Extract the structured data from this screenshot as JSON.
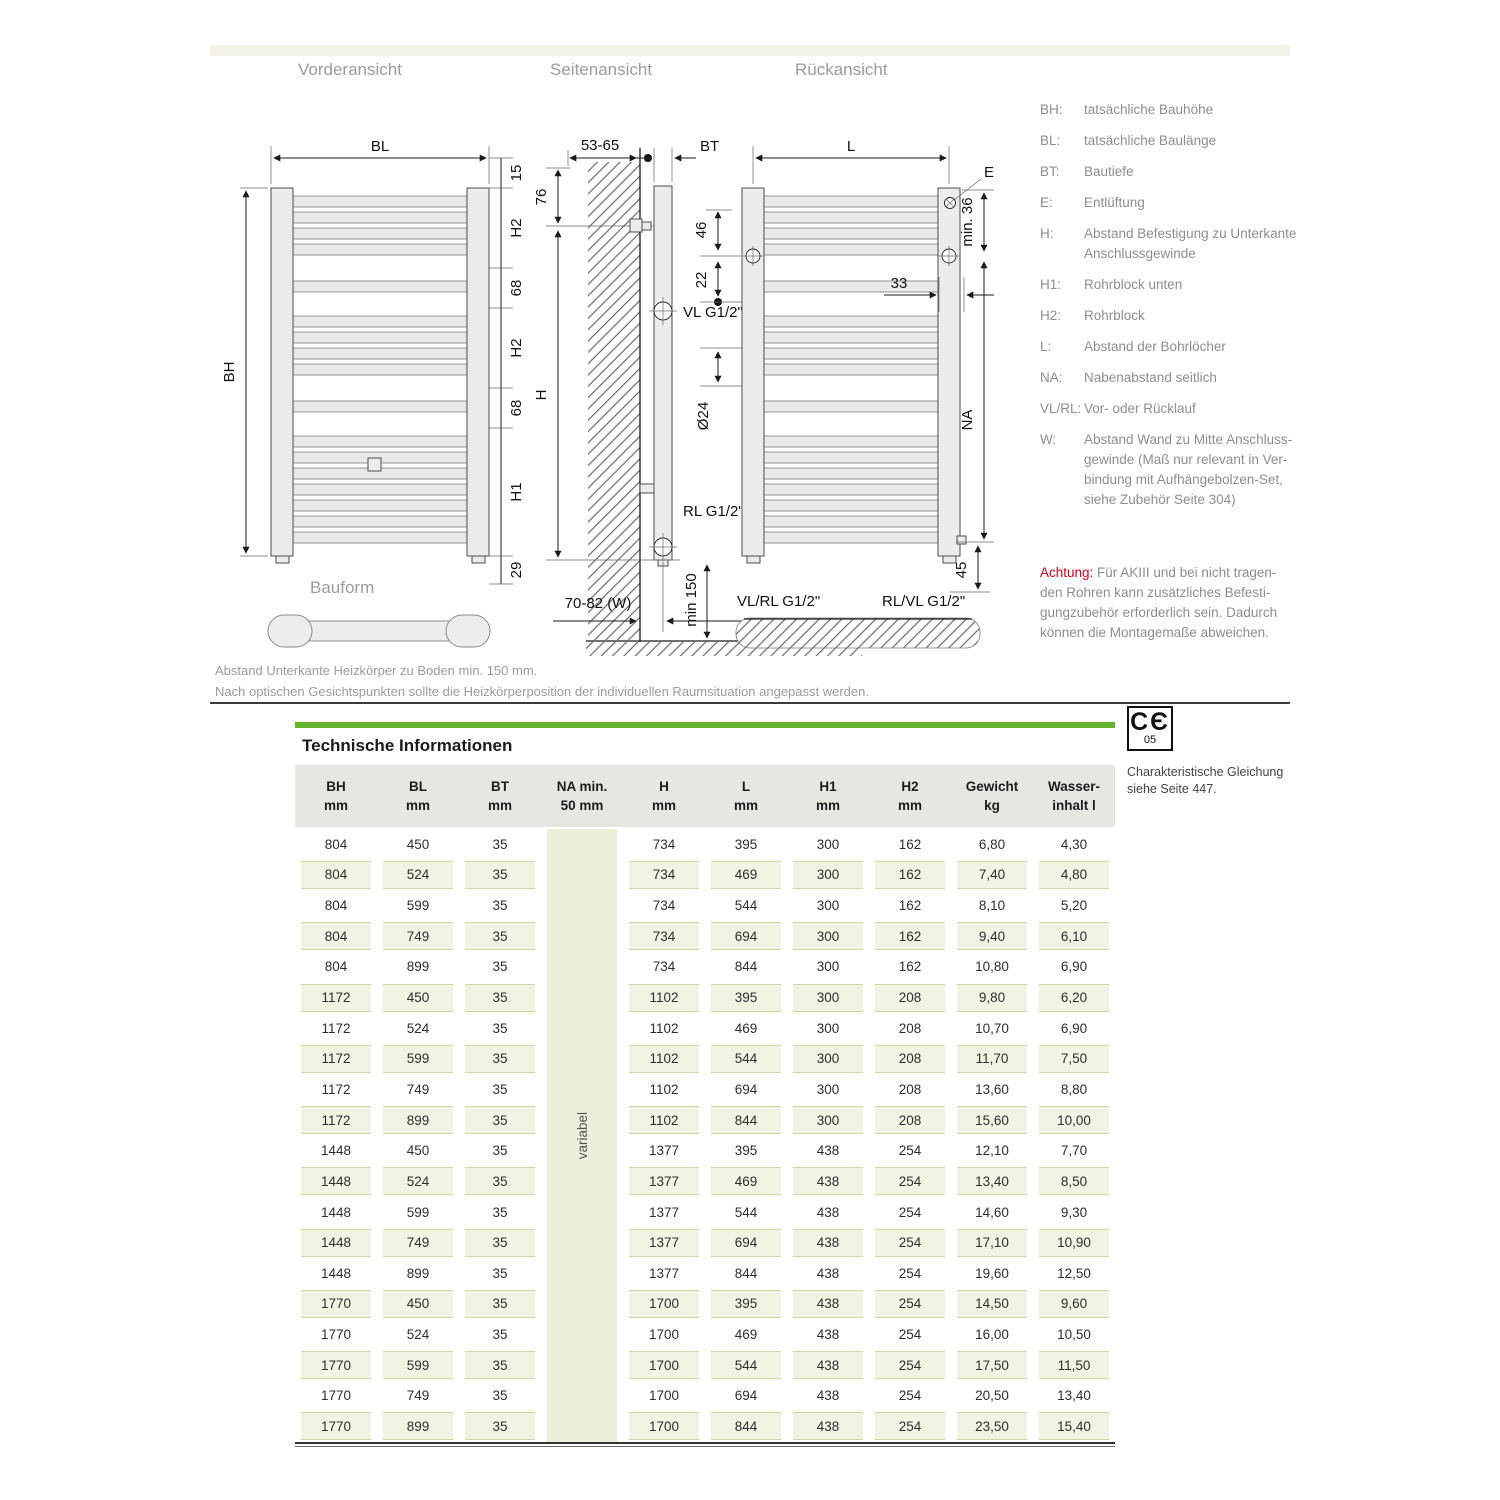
{
  "colors": {
    "accent_green": "#66b32e",
    "warning_red": "#d1001c"
  },
  "view_titles": {
    "front": "Vorderansicht",
    "side": "Seitenansicht",
    "rear": "Rückansicht"
  },
  "bauform_label": "Bauform",
  "drawing": {
    "front": {
      "bl": "BL",
      "bh": "BH",
      "d15": "15",
      "h2_top": "H2",
      "d68_top": "68",
      "h2_mid": "H2",
      "d68_bot": "68",
      "h1": "H1",
      "d29": "29"
    },
    "side": {
      "wall_dist": "53-65",
      "bt": "BT",
      "d76": "76",
      "h": "H",
      "vl": "VL G1/2\"",
      "rl": "RL G1/2\"",
      "min150": "min 150",
      "w": "70-82 (W)"
    },
    "rear": {
      "l": "L",
      "e": "E",
      "d46": "46",
      "d22": "22",
      "dia24": "Ø24",
      "d33": "33",
      "min36": "min. 36",
      "na": "NA",
      "d45": "45",
      "vlrl": "VL/RL G1/2\"",
      "rlvl": "RL/VL G1/2\""
    }
  },
  "legend": {
    "items": [
      {
        "key": "BH:",
        "text": "tatsächliche Bauhöhe"
      },
      {
        "key": "BL:",
        "text": "tatsächliche Baulänge"
      },
      {
        "key": "BT:",
        "text": "Bautiefe"
      },
      {
        "key": "E:",
        "text": "Entlüftung"
      },
      {
        "key": "H:",
        "text": "Abstand Befestigung zu Unterkante\nAnschlussgewinde"
      },
      {
        "key": "H1:",
        "text": "Rohrblock unten"
      },
      {
        "key": "H2:",
        "text": "Rohrblock"
      },
      {
        "key": "L:",
        "text": "Abstand der Bohrlöcher"
      },
      {
        "key": "NA:",
        "text": "Nabenabstand seitlich"
      },
      {
        "key": "VL/RL:",
        "text": "Vor- oder Rücklauf"
      },
      {
        "key": "W:",
        "text": "Abstand Wand zu Mitte Anschluss-\ngewinde (Maß nur relevant in Ver-\nbindung mit Aufhängebolzen-Set,\nsiehe Zubehör Seite 304)"
      }
    ],
    "warning_label": "Achtung:",
    "warning_text": " Für AKIII und bei nicht tragen-\nden Rohren kann zusätzliches Befesti-\ngungzubehör erforderlich sein. Dadurch\nkönnen die Montagemaße abweichen."
  },
  "footnotes": {
    "line1": "Abstand Unterkante Heizkörper zu Boden min. 150 mm.",
    "line2": "Nach optischen Gesichtspunkten sollte die Heizkörperposition der individuellen Raumsituation angepasst werden."
  },
  "table": {
    "title": "Technische Informationen",
    "na_value": "variabel",
    "columns": [
      {
        "top": "BH",
        "bottom": "mm"
      },
      {
        "top": "BL",
        "bottom": "mm"
      },
      {
        "top": "BT",
        "bottom": "mm"
      },
      {
        "top": "NA min.",
        "bottom": "50 mm"
      },
      {
        "top": "H",
        "bottom": "mm"
      },
      {
        "top": "L",
        "bottom": "mm"
      },
      {
        "top": "H1",
        "bottom": "mm"
      },
      {
        "top": "H2",
        "bottom": "mm"
      },
      {
        "top": "Gewicht",
        "bottom": "kg"
      },
      {
        "top": "Wasser-",
        "bottom": "inhalt l"
      }
    ],
    "rows": [
      [
        "804",
        "450",
        "35",
        "734",
        "395",
        "300",
        "162",
        "6,80",
        "4,30"
      ],
      [
        "804",
        "524",
        "35",
        "734",
        "469",
        "300",
        "162",
        "7,40",
        "4,80"
      ],
      [
        "804",
        "599",
        "35",
        "734",
        "544",
        "300",
        "162",
        "8,10",
        "5,20"
      ],
      [
        "804",
        "749",
        "35",
        "734",
        "694",
        "300",
        "162",
        "9,40",
        "6,10"
      ],
      [
        "804",
        "899",
        "35",
        "734",
        "844",
        "300",
        "162",
        "10,80",
        "6,90"
      ],
      [
        "1172",
        "450",
        "35",
        "1102",
        "395",
        "300",
        "208",
        "9,80",
        "6,20"
      ],
      [
        "1172",
        "524",
        "35",
        "1102",
        "469",
        "300",
        "208",
        "10,70",
        "6,90"
      ],
      [
        "1172",
        "599",
        "35",
        "1102",
        "544",
        "300",
        "208",
        "11,70",
        "7,50"
      ],
      [
        "1172",
        "749",
        "35",
        "1102",
        "694",
        "300",
        "208",
        "13,60",
        "8,80"
      ],
      [
        "1172",
        "899",
        "35",
        "1102",
        "844",
        "300",
        "208",
        "15,60",
        "10,00"
      ],
      [
        "1448",
        "450",
        "35",
        "1377",
        "395",
        "438",
        "254",
        "12,10",
        "7,70"
      ],
      [
        "1448",
        "524",
        "35",
        "1377",
        "469",
        "438",
        "254",
        "13,40",
        "8,50"
      ],
      [
        "1448",
        "599",
        "35",
        "1377",
        "544",
        "438",
        "254",
        "14,60",
        "9,30"
      ],
      [
        "1448",
        "749",
        "35",
        "1377",
        "694",
        "438",
        "254",
        "17,10",
        "10,90"
      ],
      [
        "1448",
        "899",
        "35",
        "1377",
        "844",
        "438",
        "254",
        "19,60",
        "12,50"
      ],
      [
        "1770",
        "450",
        "35",
        "1700",
        "395",
        "438",
        "254",
        "14,50",
        "9,60"
      ],
      [
        "1770",
        "524",
        "35",
        "1700",
        "469",
        "438",
        "254",
        "16,00",
        "10,50"
      ],
      [
        "1770",
        "599",
        "35",
        "1700",
        "544",
        "438",
        "254",
        "17,50",
        "11,50"
      ],
      [
        "1770",
        "749",
        "35",
        "1700",
        "694",
        "438",
        "254",
        "20,50",
        "13,40"
      ],
      [
        "1770",
        "899",
        "35",
        "1700",
        "844",
        "438",
        "254",
        "23,50",
        "15,40"
      ]
    ]
  },
  "ce": {
    "letters": "CЄ",
    "number": "05",
    "caption": "Charakteristische Gleichung\nsiehe Seite 447."
  }
}
